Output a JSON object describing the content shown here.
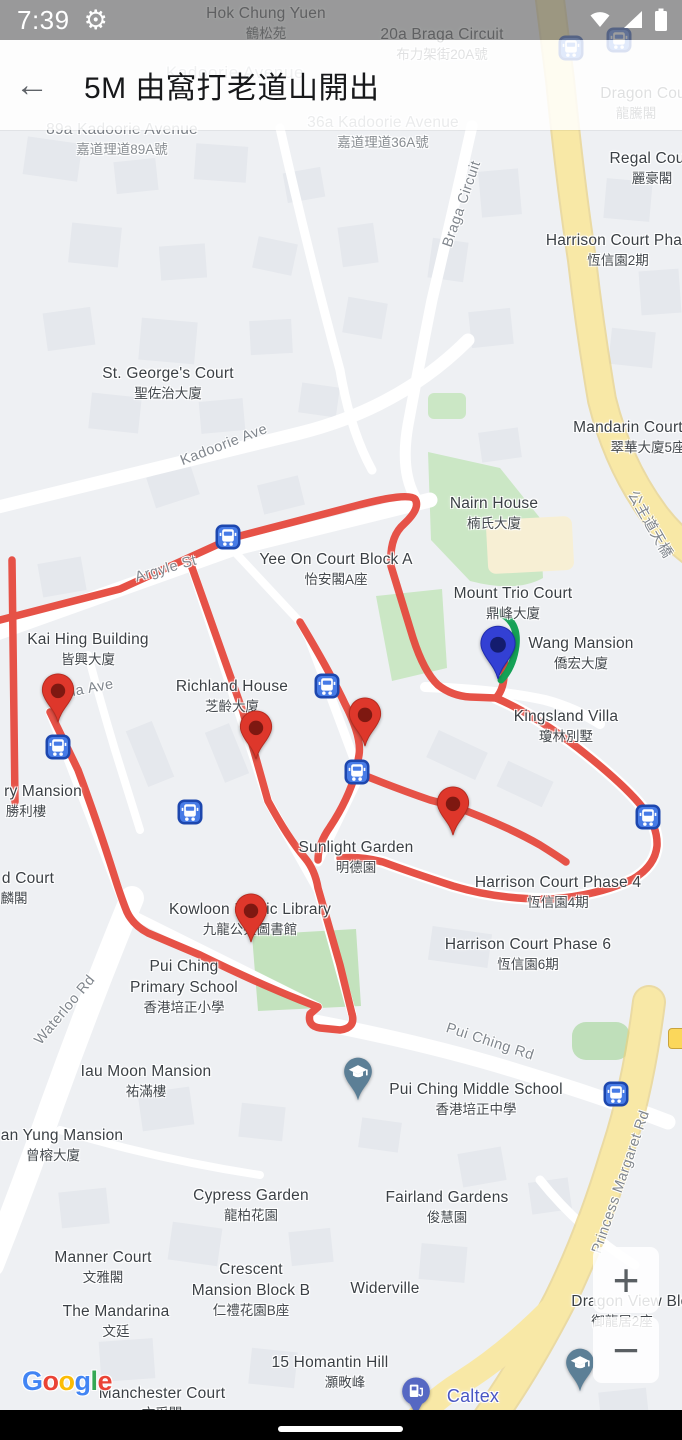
{
  "status_bar": {
    "time": "7:39"
  },
  "header": {
    "title": "5M 由窩打老道山開出"
  },
  "zoom_controls": {
    "zoom_in": "+",
    "zoom_out": "−"
  },
  "attribution": {
    "letters": [
      {
        "ch": "G",
        "color": "#4285F4"
      },
      {
        "ch": "o",
        "color": "#EA4335"
      },
      {
        "ch": "o",
        "color": "#FBBC05"
      },
      {
        "ch": "g",
        "color": "#4285F4"
      },
      {
        "ch": "l",
        "color": "#34A853"
      },
      {
        "ch": "e",
        "color": "#EA4335"
      }
    ]
  },
  "map": {
    "colors": {
      "route_red": "#E5493E",
      "route_green": "#15A156",
      "pin_red": "#DE372B",
      "pin_red_dot": "#7E1811",
      "pin_blue": "#3340D4",
      "pin_blue_dot": "#141C6E",
      "bus_fill": "#477BE6",
      "bus_border": "#1D47AE",
      "school_pin": "#5C7F96",
      "fuel_pin": "#5668C3",
      "road_yellow": "#F8E8A6",
      "park_green": "#CBE7C5"
    },
    "place_labels": [
      {
        "en": "Hok Chung Yuen",
        "zh": "鶴松苑",
        "x": 266,
        "y": 3
      },
      {
        "en": "20a Braga Circuit",
        "zh": "布力架街20A號",
        "x": 442,
        "y": 24
      },
      {
        "en": "Kadoorie Avenue",
        "x": 235,
        "y": 62,
        "t": "area"
      },
      {
        "en": "Dragon Court",
        "zh": "龍騰閣",
        "x": 648,
        "y": 83,
        "zx": 636
      },
      {
        "en": "89a Kadoorie Avenue",
        "zh": "嘉道理道89A號",
        "x": 122,
        "y": 119,
        "t": "addr"
      },
      {
        "en": "36a Kadoorie Avenue",
        "zh": "嘉道理道36A號",
        "x": 383,
        "y": 112,
        "t": "addr"
      },
      {
        "en": "Regal Court",
        "zh": "麗豪閣",
        "x": 652,
        "y": 148
      },
      {
        "en": "Harrison Court Phase 2",
        "zh": "恆信園2期",
        "x": 629,
        "y": 230,
        "zx": 618
      },
      {
        "en": "St. George's Court",
        "zh": "聖佐治大廈",
        "x": 168,
        "y": 363
      },
      {
        "en": "Mandarin Court",
        "zh": "翠華大廈5座",
        "x": 628,
        "y": 417,
        "zx": 648
      },
      {
        "en": "Nairn House",
        "zh": "楠氏大廈",
        "x": 494,
        "y": 493
      },
      {
        "en": "Yee On Court Block A",
        "zh": "怡安閣A座",
        "x": 336,
        "y": 549
      },
      {
        "en": "Mount Trio Court",
        "zh": "鼎峰大廈",
        "x": 513,
        "y": 583
      },
      {
        "en": "Kai Hing Building",
        "zh": "皆興大廈",
        "x": 88,
        "y": 629
      },
      {
        "en": "Wang Mansion",
        "zh": "僑宏大廈",
        "x": 581,
        "y": 633
      },
      {
        "en": "Richland House",
        "zh": "芝齡大廈",
        "x": 232,
        "y": 676
      },
      {
        "en": "Kingsland Villa",
        "zh": "瓊林別墅",
        "x": 566,
        "y": 706
      },
      {
        "en": "ry Mansion",
        "zh": "勝利樓",
        "x": 43,
        "y": 781,
        "zx": 26
      },
      {
        "en": "Sunlight Garden",
        "zh": "明德園",
        "x": 356,
        "y": 837
      },
      {
        "en": "Harrison Court Phase 4",
        "zh": "恆信園4期",
        "x": 558,
        "y": 872
      },
      {
        "en": "d Court",
        "zh": "麟閣",
        "x": 28,
        "y": 868,
        "zx": 14
      },
      {
        "en": "Kowloon Public Library",
        "zh": "九龍公共圖書館",
        "x": 250,
        "y": 899
      },
      {
        "en": "Harrison Court Phase 6",
        "zh": "恆信園6期",
        "x": 528,
        "y": 934
      },
      {
        "en": "Pui Ching",
        "en2": "Primary School",
        "zh": "香港培正小學",
        "x": 184,
        "y": 956
      },
      {
        "en": "Iau Moon Mansion",
        "zh": "祐滿樓",
        "x": 146,
        "y": 1061
      },
      {
        "en": "Pui Ching Middle School",
        "zh": "香港培正中學",
        "x": 476,
        "y": 1079
      },
      {
        "en": "an Yung Mansion",
        "zh": "曾榕大廈",
        "x": 62,
        "y": 1125,
        "zx": 53
      },
      {
        "en": "Cypress Garden",
        "zh": "龍柏花園",
        "x": 251,
        "y": 1185
      },
      {
        "en": "Fairland Gardens",
        "zh": "俊慧園",
        "x": 447,
        "y": 1187
      },
      {
        "en": "Manner Court",
        "zh": "文雅閣",
        "x": 103,
        "y": 1247
      },
      {
        "en": "Crescent",
        "en2": "Mansion Block B",
        "zh": "仁禮花園B座",
        "x": 251,
        "y": 1259
      },
      {
        "en": "Widerville",
        "x": 385,
        "y": 1278
      },
      {
        "en": "Dragon View Block 2",
        "zh": "御龍居2座",
        "x": 645,
        "y": 1291,
        "zx": 622
      },
      {
        "en": "The Mandarina",
        "zh": "文廷",
        "x": 116,
        "y": 1301
      },
      {
        "en": "15 Homantin Hill",
        "zh": "灝畋峰",
        "x": 330,
        "y": 1352,
        "zx": 345
      },
      {
        "en": "Manchester Court",
        "zh": "文采閣",
        "x": 162,
        "y": 1383
      },
      {
        "en": "Caltex",
        "x": 473,
        "y": 1386,
        "t": "gas"
      }
    ],
    "road_labels": [
      {
        "text": "Braga Circuit",
        "x": 462,
        "y": 204,
        "rot": -71
      },
      {
        "text": "Kadoorie Ave",
        "x": 224,
        "y": 445,
        "rot": -21
      },
      {
        "text": "Argyle St",
        "x": 166,
        "y": 569,
        "rot": -16
      },
      {
        "text": "Julia Ave",
        "x": 83,
        "y": 690,
        "rot": -11
      },
      {
        "text": "公主道天橋",
        "x": 651,
        "y": 524,
        "rot": 60
      },
      {
        "text": "Waterloo Rd",
        "x": 65,
        "y": 1010,
        "rot": -50
      },
      {
        "text": "Pui Ching Rd",
        "x": 490,
        "y": 1042,
        "rot": 18
      },
      {
        "text": "Princess Margaret Rd",
        "x": 621,
        "y": 1182,
        "rot": -71
      }
    ],
    "bus_stops": [
      [
        571,
        48
      ],
      [
        619,
        40
      ],
      [
        228,
        537
      ],
      [
        58,
        747
      ],
      [
        327,
        686
      ],
      [
        357,
        772
      ],
      [
        190,
        812
      ],
      [
        648,
        817
      ],
      [
        616,
        1094
      ]
    ],
    "red_pins": [
      [
        58,
        691
      ],
      [
        256,
        728
      ],
      [
        365,
        715
      ],
      [
        453,
        804
      ],
      [
        251,
        911
      ]
    ],
    "blue_pin": [
      498,
      645
    ],
    "school_pins": [
      [
        358,
        1072
      ],
      [
        580,
        1363
      ]
    ],
    "fuel_pin": [
      416,
      1390
    ]
  }
}
